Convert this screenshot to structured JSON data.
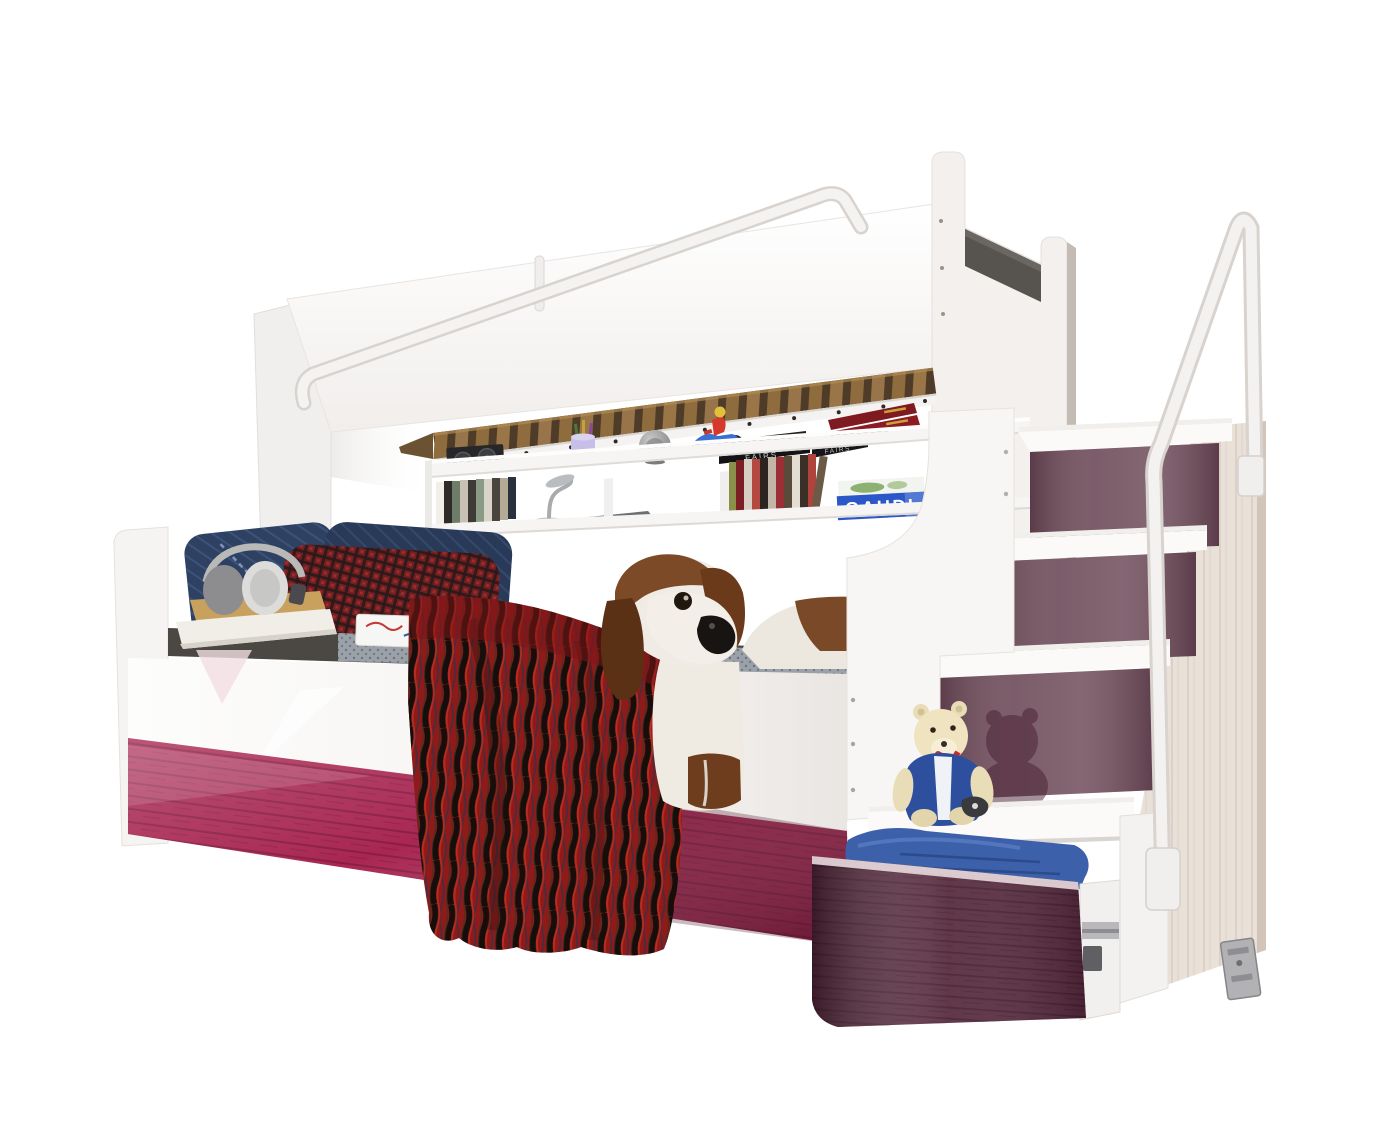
{
  "scene": {
    "description": "White bunk bed product photo: upper bunk with guard rail and wooden slats, wall shelf with books and speakers, lower bed with pillows, plush basset hound and red throw, staircase with plum glossy risers, teddy bear on step, open drawer with blue blanket"
  },
  "books": {
    "gaudi_title": "GAUDI",
    "fairs_title": "FAIRS"
  },
  "colors": {
    "magenta_panel": "#a82752",
    "plum_riser": "#6d4a59",
    "drawer_front": "#572a3d",
    "blue_blanket": "#3c60aa",
    "red_throw": "#8e1a1a",
    "denim_pillow": "#2e4162",
    "red_pillow": "#6e1416",
    "gaudi_blue": "#2b57c8",
    "teddy_vest": "#2e4f9e",
    "wood_slat": "#8f6c3e",
    "mattress_gray": "#4b4743",
    "knit_blanket": "#9aa1a8"
  }
}
